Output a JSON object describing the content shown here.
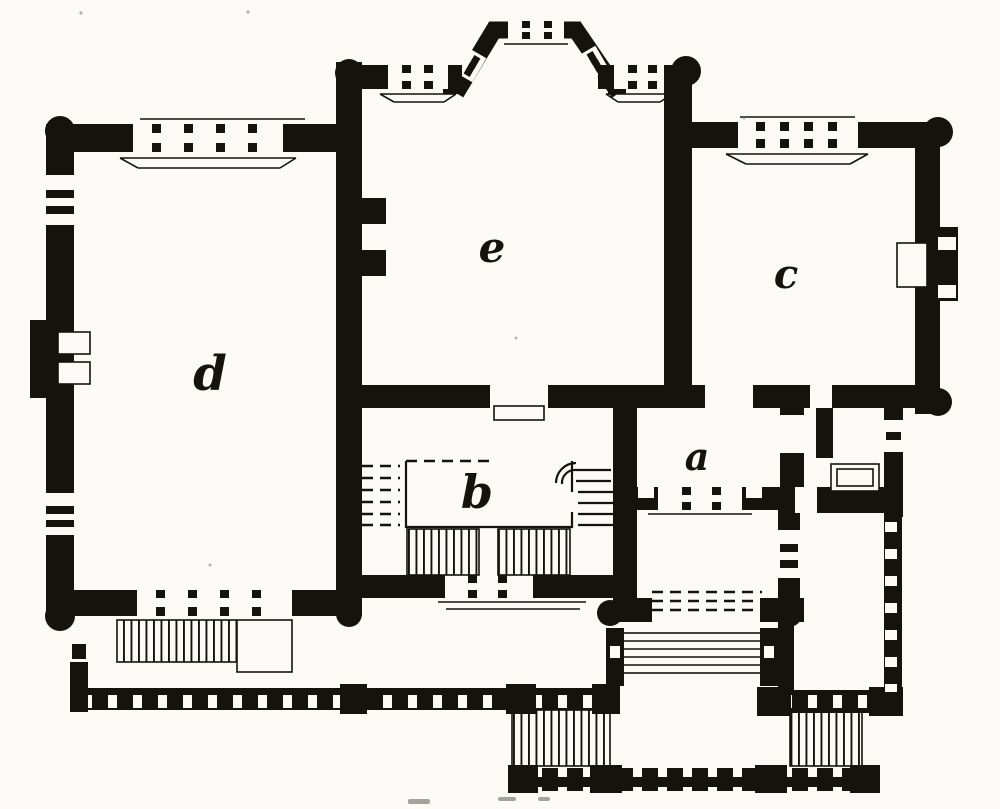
{
  "figure": {
    "kind": "engraved ground-floor plan",
    "rooms": {
      "a": {
        "label": "a"
      },
      "b": {
        "label": "b"
      },
      "c": {
        "label": "c"
      },
      "d": {
        "label": "d"
      },
      "e": {
        "label": "e"
      }
    },
    "features": [
      "canted-bay-window",
      "main-staircase",
      "entrance-porch-steps",
      "garden-terrace-balustrade",
      "side-veranda",
      "fireplaces",
      "window-mullions"
    ],
    "caption": {
      "legible": false,
      "fragment_count": 3
    }
  },
  "colors": {
    "ink": "#16130e",
    "paper": "#fbfaf7"
  }
}
